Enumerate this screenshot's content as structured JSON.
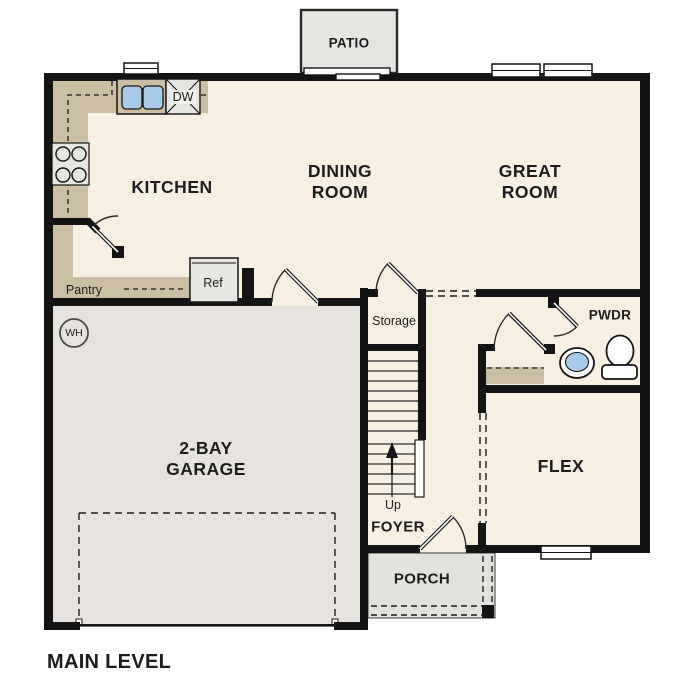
{
  "title": "MAIN LEVEL",
  "colors": {
    "wall": "#141414",
    "floor": "#f7efe2",
    "garage": "#e6e3de",
    "porch": "#e3e1dd",
    "patio": "#e7e5e2",
    "counter": "#ccbea3",
    "appliance": "#e8e6e2",
    "fixture_blue": "#a9c9e9",
    "line": "#2a2a2a"
  },
  "rooms": {
    "kitchen": "KITCHEN",
    "dining_line1": "DINING",
    "dining_line2": "ROOM",
    "great_line1": "GREAT",
    "great_line2": "ROOM",
    "garage_line1": "2-BAY",
    "garage_line2": "GARAGE",
    "flex": "FLEX",
    "pwdr": "PWDR",
    "foyer": "FOYER",
    "porch": "PORCH",
    "patio": "PATIO",
    "storage": "Storage",
    "pantry": "Pantry"
  },
  "fixtures": {
    "ref": "Ref",
    "dw": "DW",
    "wh": "WH",
    "up": "Up"
  }
}
